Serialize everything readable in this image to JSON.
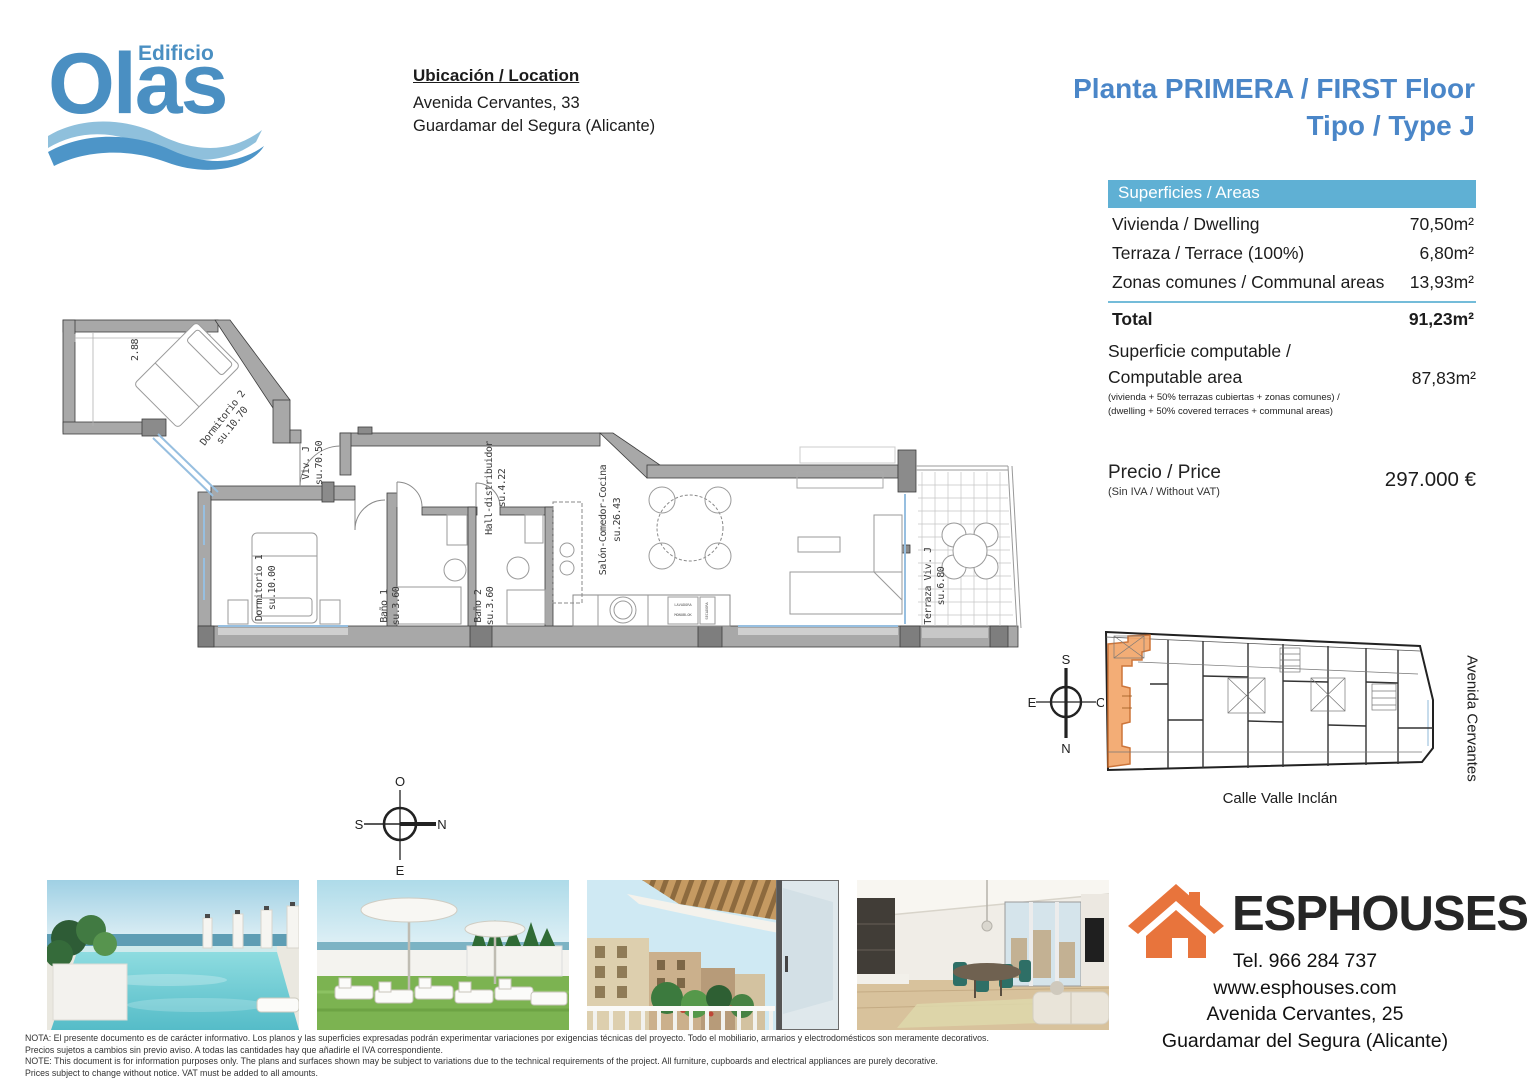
{
  "brand": {
    "edificio": "Edificio",
    "olas": "Olas"
  },
  "location": {
    "heading": "Ubicación / Location",
    "address1": "Avenida Cervantes, 33",
    "address2": "Guardamar del Segura (Alicante)"
  },
  "title": {
    "line1": "Planta PRIMERA / FIRST Floor",
    "line2": "Tipo / Type J"
  },
  "areas": {
    "header": "Superficies / Areas",
    "rows": [
      {
        "label": "Vivienda / Dwelling",
        "value": "70,50m²"
      },
      {
        "label": "Terraza / Terrace (100%)",
        "value": "6,80m²"
      },
      {
        "label": "Zonas comunes / Communal areas",
        "value": "13,93m²"
      }
    ],
    "total": {
      "label": "Total",
      "value": "91,23m²"
    },
    "computable": {
      "label1": "Superficie computable /",
      "label2": "Computable area",
      "note1": "(vivienda + 50% terrazas cubiertas + zonas comunes) /",
      "note2": "(dwelling + 50% covered terraces + communal areas)",
      "value": "87,83m²"
    }
  },
  "price": {
    "label": "Precio / Price",
    "note": "(Sin IVA / Without VAT)",
    "value": "297.000 €"
  },
  "floorplan": {
    "dimension": "2.88",
    "labels": {
      "dorm2": {
        "name": "Dormitorio 2",
        "su": "su.10.70"
      },
      "viv": {
        "name": "Viv. J",
        "su": "su.70.50"
      },
      "dorm1": {
        "name": "Dormitorio 1",
        "su": "su.10.00"
      },
      "bano1": {
        "name": "Baño 1",
        "su": "su.3.60"
      },
      "bano2": {
        "name": "Baño 2",
        "su": "su.3.60"
      },
      "hall": {
        "name": "Hall-distribuidor",
        "su": "su.4.22"
      },
      "salon": {
        "name": "Salón-Comedor-Cocina",
        "su": "su.26.43"
      },
      "terraza": {
        "name": "Terraza Viv. J",
        "su": "su.6.80"
      }
    },
    "appliances": {
      "washer1": "LAVADORA",
      "washer2": "MONOBLOK",
      "dryer": "SECADORA"
    },
    "compass": {
      "top": "O",
      "right": "N",
      "bottom": "E",
      "left": "S"
    }
  },
  "siteplan": {
    "compass": {
      "top": "S",
      "right": "O",
      "bottom": "N",
      "left": "E"
    },
    "street_right": "Avenida Cervantes",
    "street_bottom": "Calle Valle Inclán"
  },
  "footer": {
    "logo_text": "ESPHOUSES",
    "tel": "Tel. 966 284 737",
    "web": "www.esphouses.com",
    "address1": "Avenida Cervantes, 25",
    "address2": "Guardamar del Segura (Alicante)",
    "notes": [
      "NOTA: El presente documento es de carácter informativo. Los planos y las superficies expresadas podrán experimentar variaciones por exigencias técnicas del proyecto. Todo el mobiliario, armarios y electrodomésticos son meramente decorativos.",
      "Precios sujetos a cambios sin previo aviso. A todas las cantidades hay que añadirle el IVA correspondiente.",
      "NOTE: This document is for information purposes only. The plans and surfaces shown may be subject to variations due to the technical requirements of the project. All furniture, cupboards and electrical appliances are purely decorative.",
      "Prices subject to change without notice. VAT must be added to all amounts."
    ]
  },
  "colors": {
    "accent_blue": "#4a86c8",
    "panel_blue": "#5fb0d4",
    "logo_blue": "#4a8fc2",
    "orange": "#e8743c",
    "wall_gray": "#a8a8a8",
    "highlight_orange": "#f2a76b"
  }
}
